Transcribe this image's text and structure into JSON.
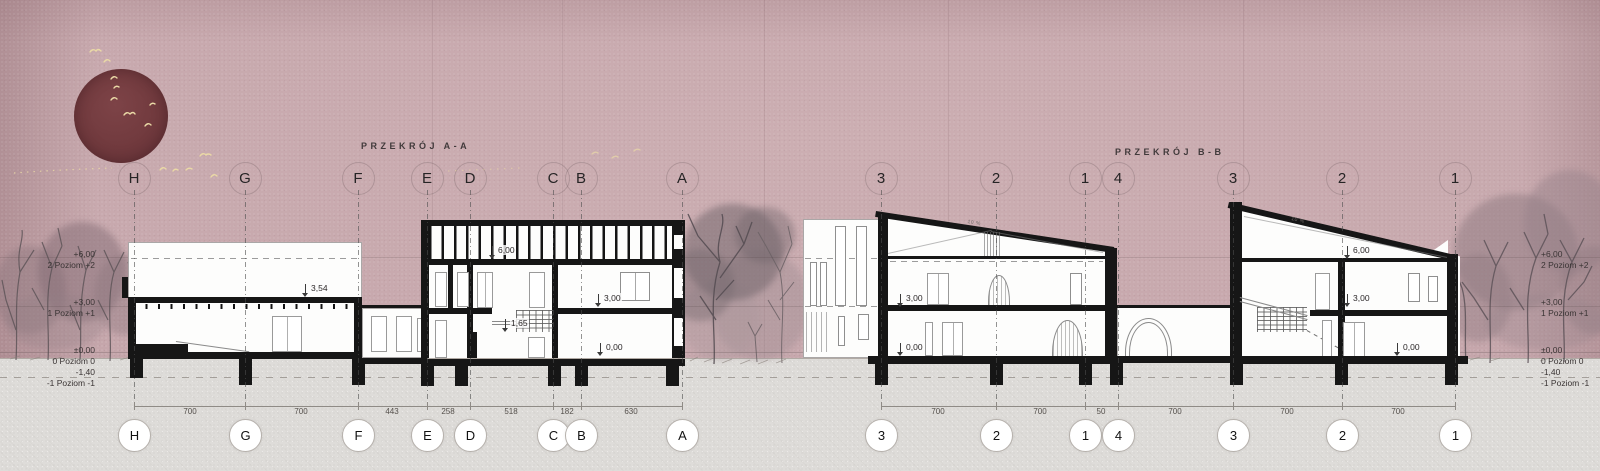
{
  "titles": {
    "section_a": "PRZEKRÓJ A-A",
    "section_b": "PRZEKRÓJ B-B"
  },
  "grid_a": [
    {
      "label": "H"
    },
    {
      "label": "G"
    },
    {
      "label": "F"
    },
    {
      "label": "E"
    },
    {
      "label": "D"
    },
    {
      "label": "C"
    },
    {
      "label": "B"
    },
    {
      "label": "A"
    }
  ],
  "dims_a": [
    {
      "value": "700"
    },
    {
      "value": "700"
    },
    {
      "value": "443"
    },
    {
      "value": "258"
    },
    {
      "value": "518"
    },
    {
      "value": "182"
    },
    {
      "value": "630"
    }
  ],
  "grid_b": [
    {
      "label": "3"
    },
    {
      "label": "2"
    },
    {
      "label": "1"
    },
    {
      "label": "4"
    },
    {
      "label": "3"
    },
    {
      "label": "2"
    },
    {
      "label": "1"
    }
  ],
  "dims_b": [
    {
      "value": "700"
    },
    {
      "value": "700"
    },
    {
      "value": "50"
    },
    {
      "value": "700"
    },
    {
      "value": "700"
    },
    {
      "value": "700"
    }
  ],
  "elev_a": {
    "e354": "3,54",
    "e600": "6,00",
    "e300": "3,00",
    "e165": "1,65",
    "e000": "0,00"
  },
  "elev_b1": {
    "e300": "3,00",
    "e000": "0,00"
  },
  "elev_b2": {
    "e600": "6,00",
    "e300": "3,00",
    "e000": "0,00"
  },
  "roof_slope_label": "10 %",
  "levels": [
    {
      "value": "+6,00",
      "name": "2 Poziom +2"
    },
    {
      "value": "+3,00",
      "name": "1 Poziom +1"
    },
    {
      "value": "±0,00",
      "name": "0 Poziom 0"
    },
    {
      "value": "-1,40",
      "name": "-1 Poziom -1"
    }
  ],
  "colors": {
    "background": "#c7a8ad",
    "sun": "#713a3e",
    "ground": "#dedcd9",
    "ink": "#161616",
    "birds": "#ead9a6"
  }
}
